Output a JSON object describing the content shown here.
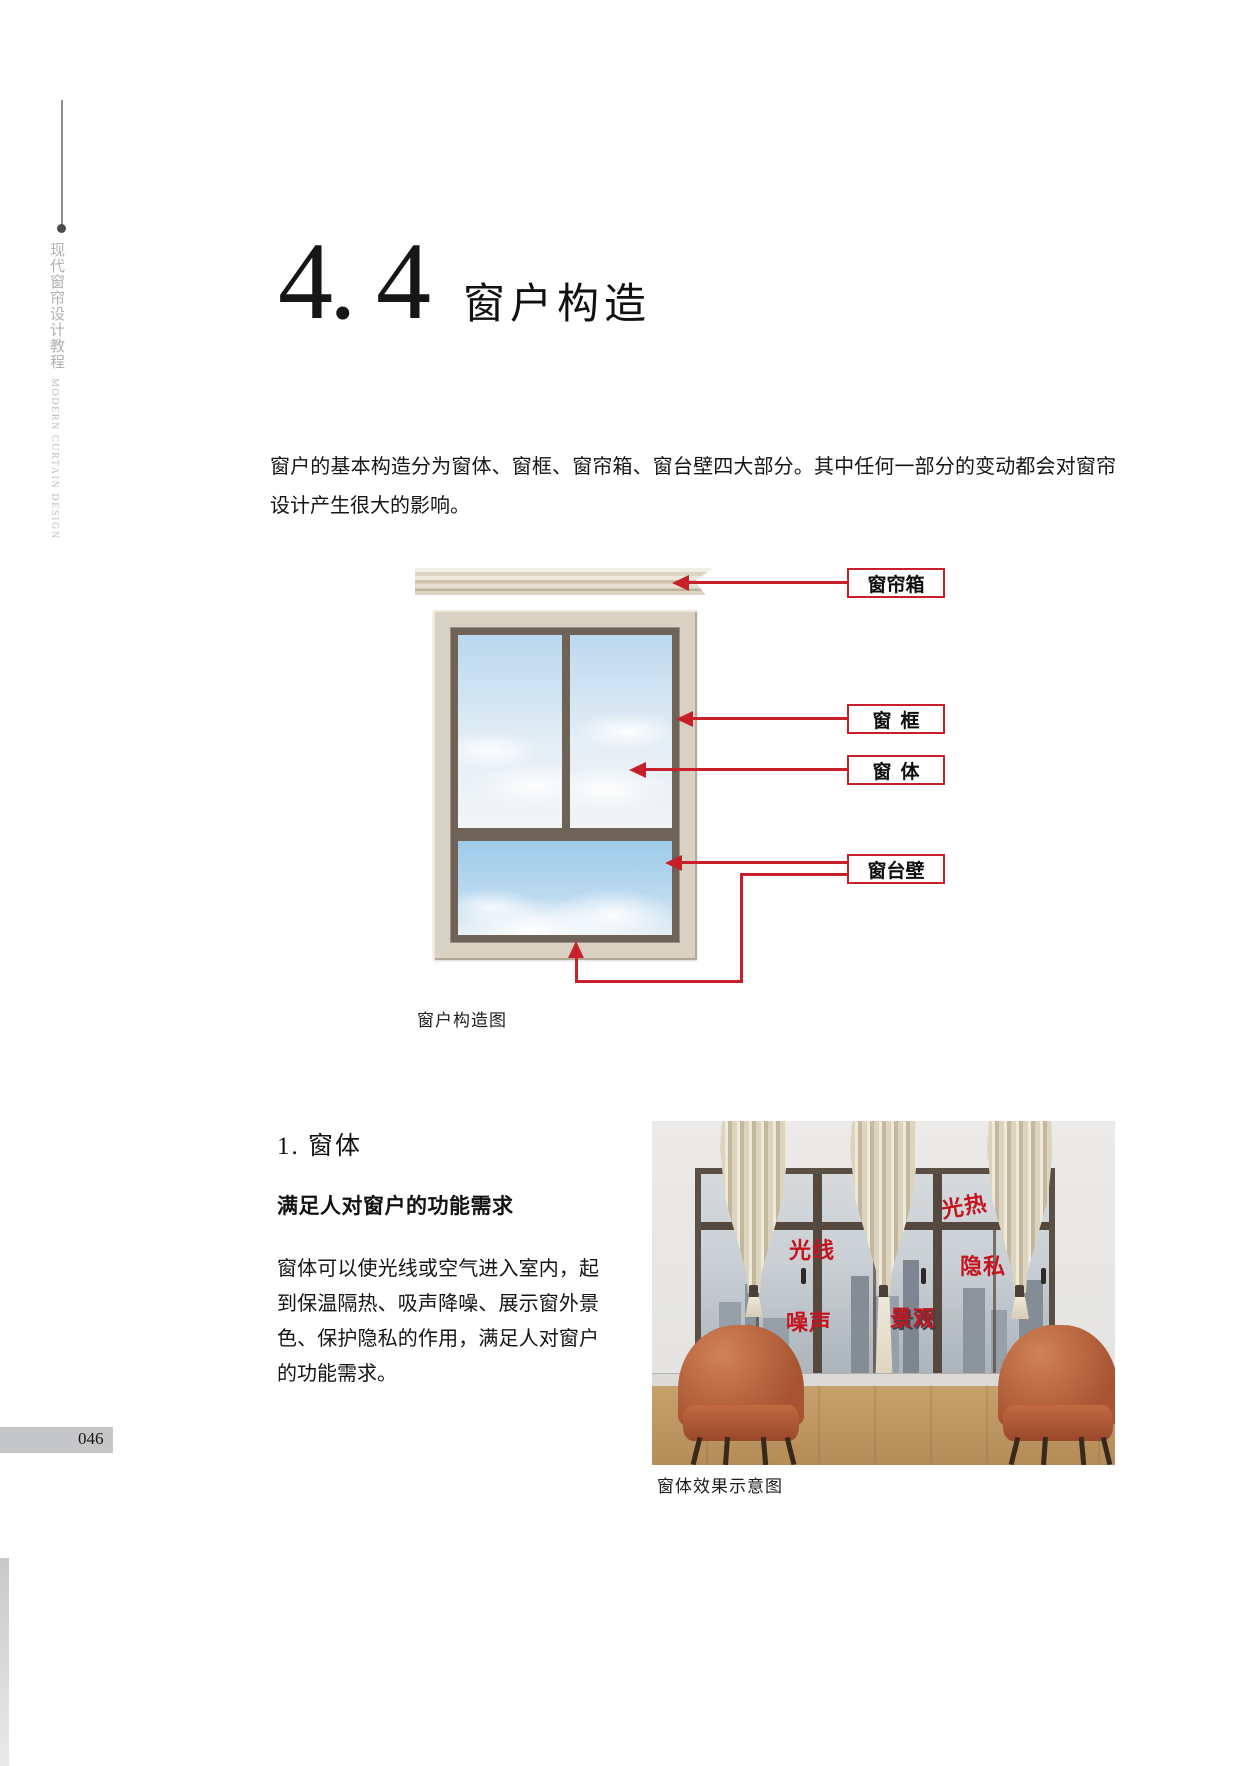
{
  "sidebar": {
    "title_cn": "现代窗帘设计教程",
    "title_en": "MODERN CURTAIN DESIGN"
  },
  "heading": {
    "number": "4. 4",
    "title": "窗户构造"
  },
  "intro": {
    "text": "窗户的基本构造分为窗体、窗框、窗帘箱、窗台壁四大部分。其中任何一部分的变动都会对窗帘设计产生很大的影响。"
  },
  "diagram": {
    "labels": [
      "窗帘箱",
      "窗框",
      "窗体",
      "窗台壁"
    ],
    "caption": "窗户构造图"
  },
  "section": {
    "heading": "1. 窗体",
    "subheading": "满足人对窗户的功能需求",
    "body": "窗体可以使光线或空气进入室内，起到保温隔热、吸声降噪、展示窗外景色、保护隐私的作用，满足人对窗户的功能需求。"
  },
  "photo": {
    "labels": [
      "光线",
      "光热",
      "隐私",
      "噪声",
      "景观"
    ],
    "caption": "窗体效果示意图"
  },
  "footer": {
    "page_number": "046"
  },
  "colors": {
    "accent_red": "#c8202a",
    "photo_label_red": "#c41420",
    "frame_beige": "#d9d1c2",
    "dark_frame": "#6e6356",
    "chair_orange": "#b9643e",
    "floor_wood": "#bd9662"
  }
}
